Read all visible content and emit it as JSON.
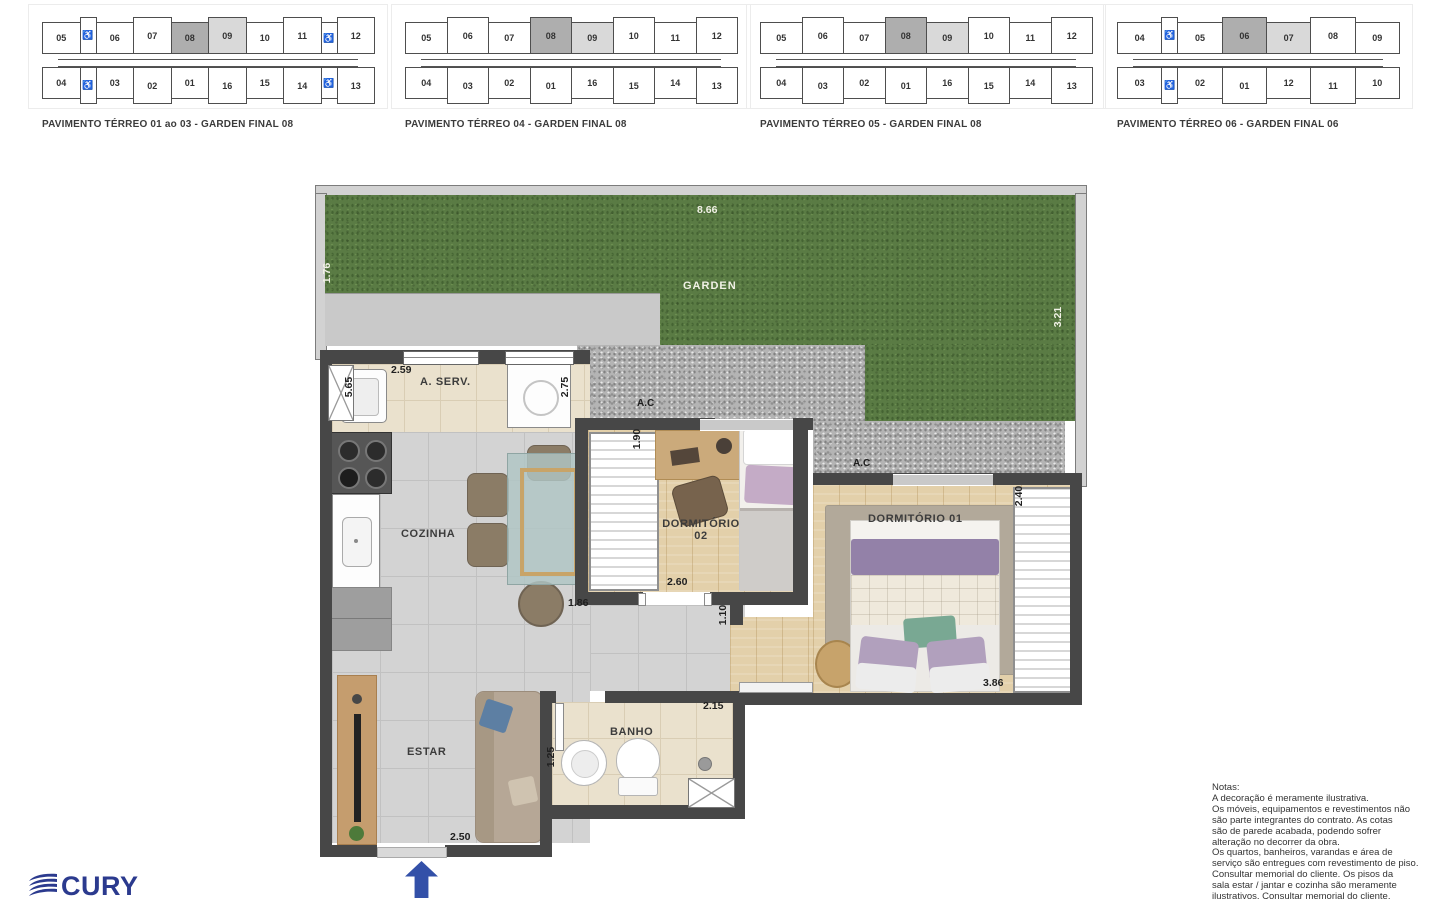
{
  "key_plans": [
    {
      "label": "PAVIMENTO TÉRREO 01 ao 03 - GARDEN FINAL 08",
      "top_row": [
        {
          "t": "05"
        },
        {
          "t": "♿",
          "wc": true
        },
        {
          "t": "06"
        },
        {
          "t": "07"
        },
        {
          "t": "08",
          "hl": "dark"
        },
        {
          "t": "09",
          "hl": "light"
        },
        {
          "t": "10"
        },
        {
          "t": "11"
        },
        {
          "t": "♿",
          "wc": true
        },
        {
          "t": "12"
        }
      ],
      "bottom_row": [
        {
          "t": "04"
        },
        {
          "t": "♿",
          "wc": true
        },
        {
          "t": "03"
        },
        {
          "t": "02"
        },
        {
          "t": "01"
        },
        {
          "t": "16"
        },
        {
          "t": "15"
        },
        {
          "t": "14"
        },
        {
          "t": "♿",
          "wc": true
        },
        {
          "t": "13"
        }
      ]
    },
    {
      "label": "PAVIMENTO TÉRREO 04 - GARDEN FINAL 08",
      "top_row": [
        {
          "t": "05"
        },
        {
          "t": "06"
        },
        {
          "t": "07"
        },
        {
          "t": "08",
          "hl": "dark"
        },
        {
          "t": "09",
          "hl": "light"
        },
        {
          "t": "10"
        },
        {
          "t": "11"
        },
        {
          "t": "12"
        }
      ],
      "bottom_row": [
        {
          "t": "04"
        },
        {
          "t": "03"
        },
        {
          "t": "02"
        },
        {
          "t": "01"
        },
        {
          "t": "16"
        },
        {
          "t": "15"
        },
        {
          "t": "14"
        },
        {
          "t": "13"
        }
      ]
    },
    {
      "label": "PAVIMENTO TÉRREO 05 - GARDEN FINAL 08",
      "top_row": [
        {
          "t": "05"
        },
        {
          "t": "06"
        },
        {
          "t": "07"
        },
        {
          "t": "08",
          "hl": "dark"
        },
        {
          "t": "09",
          "hl": "light"
        },
        {
          "t": "10"
        },
        {
          "t": "11"
        },
        {
          "t": "12"
        }
      ],
      "bottom_row": [
        {
          "t": "04"
        },
        {
          "t": "03"
        },
        {
          "t": "02"
        },
        {
          "t": "01"
        },
        {
          "t": "16"
        },
        {
          "t": "15"
        },
        {
          "t": "14"
        },
        {
          "t": "13"
        }
      ]
    },
    {
      "label": "PAVIMENTO TÉRREO 06 - GARDEN FINAL 06",
      "top_row": [
        {
          "t": "04"
        },
        {
          "t": "♿",
          "wc": true
        },
        {
          "t": "05"
        },
        {
          "t": "06",
          "hl": "dark"
        },
        {
          "t": "07",
          "hl": "light"
        },
        {
          "t": "08"
        },
        {
          "t": "09"
        }
      ],
      "bottom_row": [
        {
          "t": "03"
        },
        {
          "t": "♿",
          "wc": true
        },
        {
          "t": "02"
        },
        {
          "t": "01"
        },
        {
          "t": "12"
        },
        {
          "t": "11"
        },
        {
          "t": "10"
        }
      ]
    }
  ],
  "plan": {
    "rooms": {
      "garden": "GARDEN",
      "aserv": "A. SERV.",
      "cozinha": "COZINHA",
      "dorm2_line1": "DORMITÓRIO",
      "dorm2_line2": "02",
      "dorm1": "DORMITÓRIO 01",
      "estar": "ESTAR",
      "banho": "BANHO",
      "ac1": "A.C",
      "ac2": "A.C"
    },
    "dims": {
      "garden_w": "8.66",
      "garden_left": "1.76",
      "garden_right": "3.21",
      "aserv_h": "5.65",
      "aserv_w": "2.59",
      "aserv_r": "2.75",
      "dorm2_h": "1.90",
      "dorm2_w": "2.60",
      "kitchen_w": "1.86",
      "corridor": "1.10",
      "dorm1_h": "2.40",
      "dorm1_w": "3.86",
      "banho_w": "2.15",
      "banho_h": "1.25",
      "estar_w": "2.50"
    }
  },
  "notes": {
    "lines": [
      "Notas:",
      "A decoração é meramente ilustrativa.",
      "Os móveis, equipamentos e revestimentos não",
      "são parte integrantes do contrato. As cotas",
      "são de parede acabada, podendo sofrer",
      "alteração no decorrer da obra.",
      "Os quartos, banheiros, varandas e área de",
      "serviço são entregues com revestimento de piso.",
      "Consultar memorial do cliente. Os pisos da",
      "sala estar / jantar e cozinha são meramente",
      "ilustrativos. Consultar memorial do cliente."
    ]
  },
  "logo": {
    "text": "CURY",
    "color": "#2b3a8e"
  },
  "colors": {
    "wall": "#474747",
    "grass": "#5a7b44",
    "highlight_dark": "#aeaeae",
    "highlight_light": "#d9d9d9",
    "arrow_blue": "#3350a8"
  }
}
